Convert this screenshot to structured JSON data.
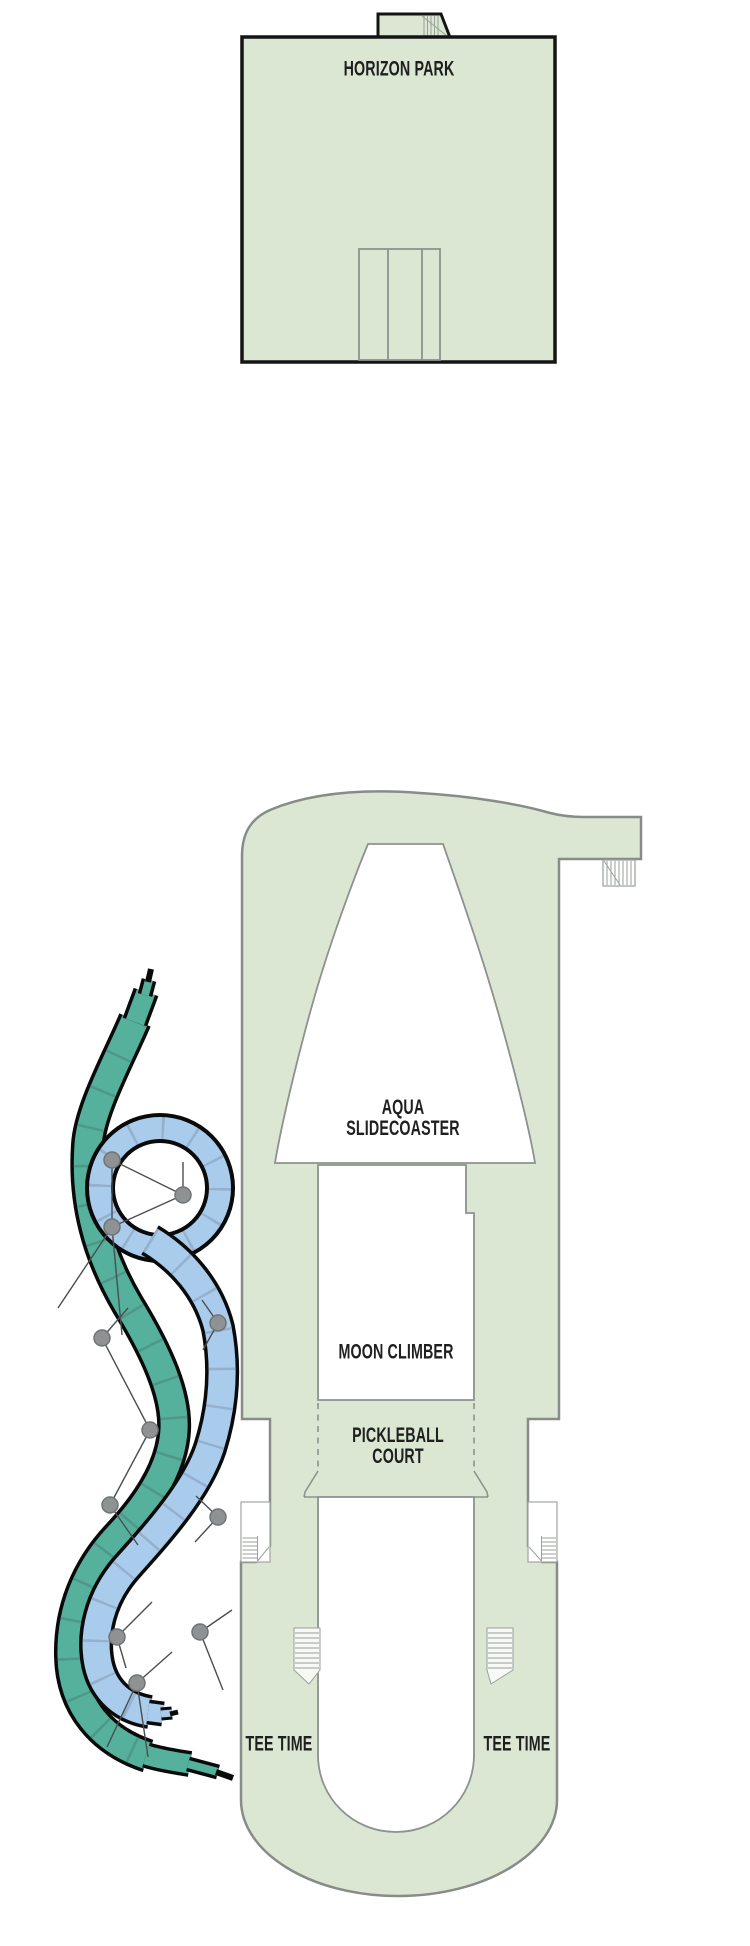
{
  "plan": {
    "title": "cruise ship deck plan",
    "upper_deck": {
      "label": "HORIZON PARK"
    },
    "features": {
      "aqua_slidecoaster": {
        "line1": "AQUA",
        "line2": "SLIDECOASTER"
      },
      "moon_climber": {
        "label": "MOON CLIMBER"
      },
      "pickleball_court": {
        "line1": "PICKLEBALL",
        "line2": "COURT"
      },
      "tee_time_left": {
        "label": "TEE TIME"
      },
      "tee_time_right": {
        "label": "TEE TIME"
      }
    },
    "icons": {
      "stairs": "stairs-icon",
      "slide_supports": "support-pylon-icon"
    },
    "colors": {
      "deck_fill": "#dbe7d3",
      "deck_outline": "#878c87",
      "upper_deck_outline": "#141414",
      "inner_line": "#8d928d",
      "stair_line": "#9aa09a",
      "slide_teal": "#55b09c",
      "slide_teal_segment": "#4c9184",
      "slide_blue": "#a9cced",
      "slide_blue_segment": "#8fa9c4",
      "slide_outline": "#0a0a0a",
      "support_gray": "#8f9293",
      "label_text": "#1f1f1f"
    }
  }
}
